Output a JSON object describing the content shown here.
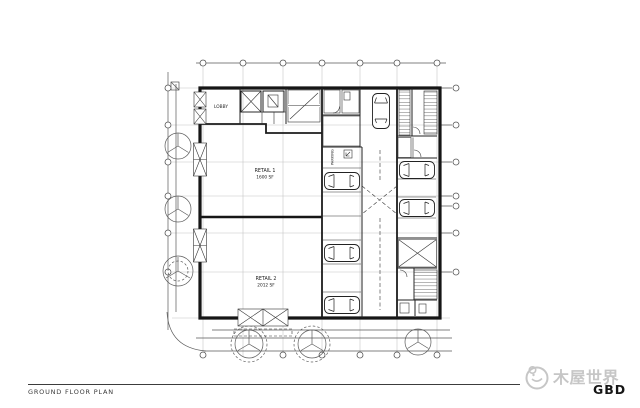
{
  "plan": {
    "labels": {
      "lobby": "LOBBY",
      "retail1_name": "RETAIL 1",
      "retail1_area": "1600 SF",
      "retail2_name": "RETAIL 2",
      "retail2_area": "2012 SF",
      "parking": "PARKING"
    },
    "colors": {
      "ink": "#1c1c1c",
      "grid": "#c2c2c2",
      "dimension": "#5a5a5a"
    }
  },
  "footer": {
    "title": "GROUND FLOOR PLAN"
  },
  "watermark": {
    "brand_cn": "木屋世界",
    "brand_en": "GBD",
    "color": "#c6c6c6"
  }
}
